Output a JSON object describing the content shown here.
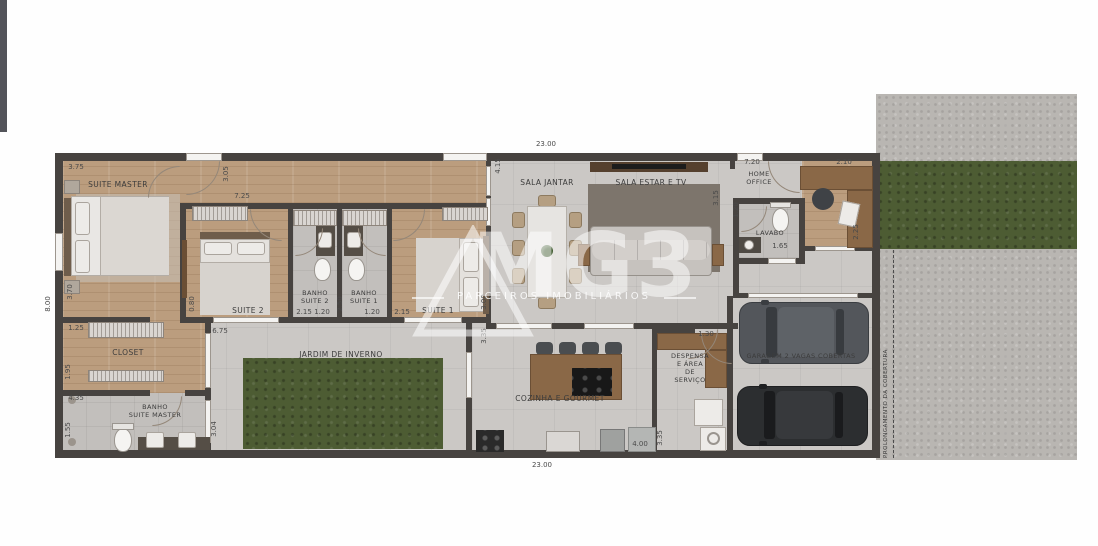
{
  "watermark": {
    "brand": "MG3",
    "tagline": "PARCEIROS IMOBILIÁRIOS"
  },
  "site_note": "PROLONGAMENTO DA COBERTURA",
  "overall": {
    "width_top": "23.00",
    "width_bottom": "23.00",
    "height_left": "8.00"
  },
  "rooms": {
    "suite_master": "SUITE MASTER",
    "suite_2": "SUITE 2",
    "suite_1": "SUITE 1",
    "banho_suite_2": "BANHO\nSUITE 2",
    "banho_suite_1": "BANHO\nSUITE 1",
    "closet": "CLOSET",
    "banho_suite_master": "BANHO\nSUITE MASTER",
    "jardim": "JARDIM DE INVERNO",
    "sala_jantar": "SALA JANTAR",
    "sala_estar": "SALA ESTAR E TV",
    "home_office": "HOME\nOFFICE",
    "lavabo": "LAVABO",
    "cozinha": "COZINHA E GOURMET",
    "despensa": "DESPENSA\nE ÁREA\nDE\nSERVIÇO",
    "garagem": "GARAGEM 2 VAGAS COBERTAS"
  },
  "dims": {
    "suite_master_w": "3.75",
    "suite_master_d": "3.70",
    "closet_w": "1.25",
    "closet_d": "1.95",
    "banho_master_w": "4.35",
    "banho_master_d": "1.55",
    "banho_master_r": "3.04",
    "hall_door": "3.05",
    "hall_len": "7.25",
    "suite2_off": "0.80",
    "suite2_w": "2.15",
    "suites_span": "6.75",
    "banho2_w": "1.20",
    "banho1_w": "1.20",
    "banhos_d": "2.50",
    "suite1_w": "2.15",
    "suite1_d": "3.00",
    "jardim_win": "3.35",
    "sala_jantar_d": "4.15",
    "sala_estar_d": "3.15",
    "lavabo_d": "1.20",
    "lavabo_w": "1.65",
    "office_hall_w": "7.20",
    "home_office_w": "2.10",
    "home_office_d": "2.25",
    "despensa_door": "1.30",
    "cozinha_w": "4.00",
    "cozinha_d": "3.35"
  }
}
